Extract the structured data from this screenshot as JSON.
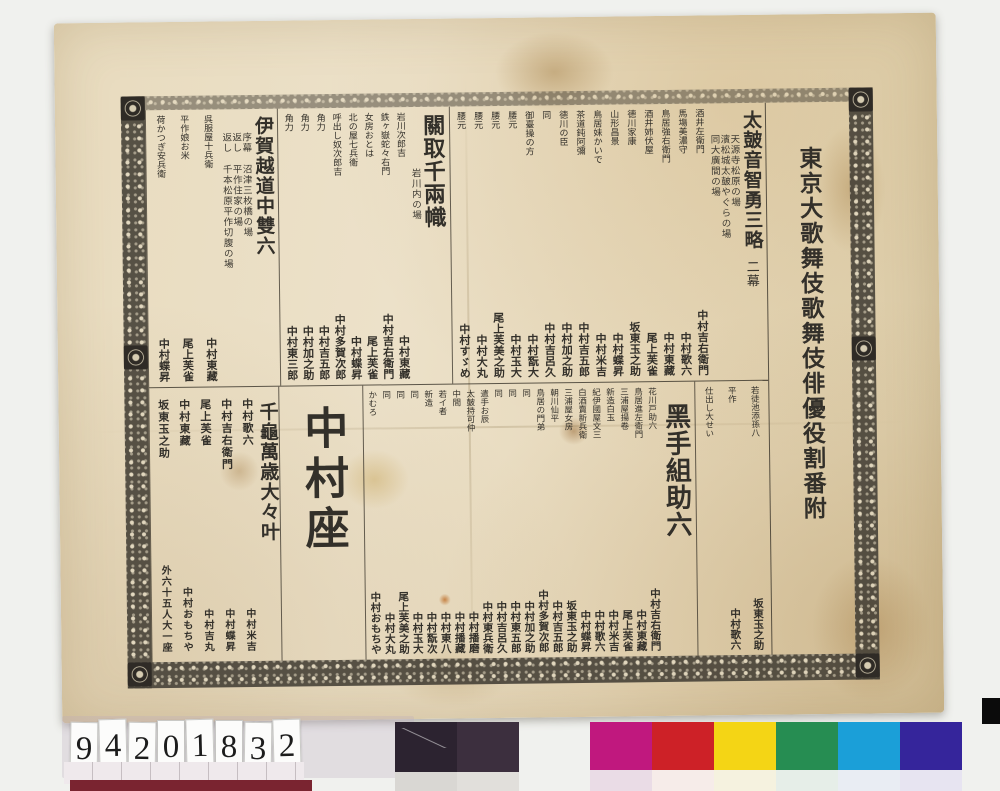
{
  "document": {
    "main_title": "東京大歌舞伎歌舞伎俳優役割番附",
    "plays": [
      {
        "title": "太皷音智勇三略",
        "acts": "二幕",
        "scenes": [
          "天源寺松原の場",
          "濱松城太皷やぐらの場",
          "同大廣間の場"
        ],
        "cast": [
          {
            "role": "酒井左衛門",
            "actor": "中村吉右衛門"
          },
          {
            "role": "馬塲美濃守",
            "actor": "中村歌六"
          },
          {
            "role": "鳥居強右衛門",
            "actor": "中村東藏"
          },
          {
            "role": "酒井姉伏屋",
            "actor": "尾上芙雀"
          },
          {
            "role": "德川家康",
            "actor": "坂東玉之助"
          },
          {
            "role": "山形昌景",
            "actor": "中村蝶昇"
          },
          {
            "role": "鳥居妹かいで",
            "actor": "中村米吉"
          },
          {
            "role": "茶道鈍阿彌",
            "actor": "中村吉五郎"
          },
          {
            "role": "德川の臣",
            "actor": "中村加之助"
          },
          {
            "role": "同",
            "actor": "中村吉呂久"
          },
          {
            "role": "御臺操の方",
            "actor": "中村翫大"
          },
          {
            "role": "腰元",
            "actor": "中村玉大"
          },
          {
            "role": "腰元",
            "actor": "尾上芙美之助"
          },
          {
            "role": "腰元",
            "actor": "中村大丸"
          },
          {
            "role": "腰元",
            "actor": "中村すゞめ"
          }
        ]
      },
      {
        "title": "關取千兩幟",
        "scenes": [
          "岩川内の場"
        ],
        "cast": [
          {
            "role": "岩川次郎吉",
            "actor": "中村東藏"
          },
          {
            "role": "鉄ヶ嶽蛇々右門",
            "actor": "中村吉右衛門"
          },
          {
            "role": "女房おとは",
            "actor": "尾上芙雀"
          },
          {
            "role": "北の屋七兵衛",
            "actor": "中村蝶昇"
          },
          {
            "role": "呼出し奴次郎吉",
            "actor": "中村多賀次郎"
          },
          {
            "role": "角力",
            "actor": "中村吉五郎"
          },
          {
            "role": "角力",
            "actor": "中村加之助"
          },
          {
            "role": "角力",
            "actor": "中村東三郎"
          }
        ]
      },
      {
        "title": "伊賀越道中雙六",
        "scenes": [
          "序幕 沼津三枚橋の場",
          "返し 平作住家の場",
          "返し 千本松原平作切腹の場"
        ],
        "cast": [
          {
            "role": "呉服屋十兵衛",
            "actor": "中村東藏"
          },
          {
            "role": "平作娘お米",
            "actor": "尾上芙雀"
          },
          {
            "role": "荷かつぎ安兵衛",
            "actor": "中村蝶昇"
          }
        ],
        "cast_continued": [
          {
            "role": "若徒池添孫八",
            "actor": "坂東玉之助"
          },
          {
            "role": "平作",
            "actor": "中村歌六"
          },
          {
            "role": "仕出し大せい",
            "actor": ""
          }
        ]
      },
      {
        "title": "黑手組助六",
        "cast": [
          {
            "role": "花川戸助六",
            "actor": "中村吉右衛門"
          },
          {
            "role": "鳥居進左衛門",
            "actor": "中村東藏"
          },
          {
            "role": "三浦屋揚卷",
            "actor": "尾上芙雀"
          },
          {
            "role": "新造白玉",
            "actor": "中村米吉"
          },
          {
            "role": "紀伊國屋文三",
            "actor": "中村歌六"
          },
          {
            "role": "白酒賣新兵衛",
            "actor": "中村蝶昇"
          },
          {
            "role": "三浦屋女房",
            "actor": "坂東玉之助"
          },
          {
            "role": "朝川仙平",
            "actor": "中村吉五郎"
          },
          {
            "role": "鳥居の門弟",
            "actor": "中村多賀次郎"
          },
          {
            "role": "同",
            "actor": "中村加之助"
          },
          {
            "role": "同",
            "actor": "中村東五郎"
          },
          {
            "role": "同",
            "actor": "中村吉呂久"
          },
          {
            "role": "遣手お辰",
            "actor": "中村東兵衛"
          },
          {
            "role": "太皷持可仲",
            "actor": "中村播磨"
          },
          {
            "role": "中間",
            "actor": "中村播藏"
          },
          {
            "role": "若イ者",
            "actor": "中村東八"
          },
          {
            "role": "新造",
            "actor": "中村翫次"
          },
          {
            "role": "同",
            "actor": "中村玉大"
          },
          {
            "role": "同",
            "actor": "尾上芙美之助"
          },
          {
            "role": "同",
            "actor": "中村大丸"
          },
          {
            "role": "かむろ",
            "actor": "中村おもちや"
          }
        ]
      }
    ],
    "troupe": {
      "banner": "千龜萬歳大々叶",
      "theater": "中村座",
      "members": [
        {
          "top": "中村歌六",
          "bottom": "中村米吉"
        },
        {
          "top": "中村吉右衛門",
          "bottom": "中村蝶昇"
        },
        {
          "top": "尾上芙雀",
          "bottom": "中村吉丸"
        },
        {
          "top": "中村東藏",
          "bottom": "中村おもちや"
        },
        {
          "top": "坂東玉之助",
          "bottom": "外六十五人大一座"
        }
      ]
    }
  },
  "photo": {
    "catalog_number": "94201832",
    "catalog_digits": [
      "9",
      "4",
      "2",
      "0",
      "1",
      "8",
      "3",
      "2"
    ],
    "ruler_color": "#7a2430",
    "grayscale_patches": [
      {
        "top": "#2c2330",
        "bottom": "#d9d7d3"
      },
      {
        "top": "#3c2f3e",
        "bottom": "#e1dfdb"
      }
    ],
    "color_patches": [
      {
        "top": "#c0187e",
        "bottom": "#eadce6"
      },
      {
        "top": "#cd2127",
        "bottom": "#f6ece9"
      },
      {
        "top": "#f4d515",
        "bottom": "#f5f2df"
      },
      {
        "top": "#268d52",
        "bottom": "#e6eee8"
      },
      {
        "top": "#1b9fd8",
        "bottom": "#e9edf3"
      },
      {
        "top": "#35259b",
        "bottom": "#e7e4f1"
      }
    ],
    "colors": {
      "paper": "#e8dcc0",
      "ink": "#33302a",
      "border": "#474238",
      "backdrop": "#f0f1ee"
    }
  }
}
